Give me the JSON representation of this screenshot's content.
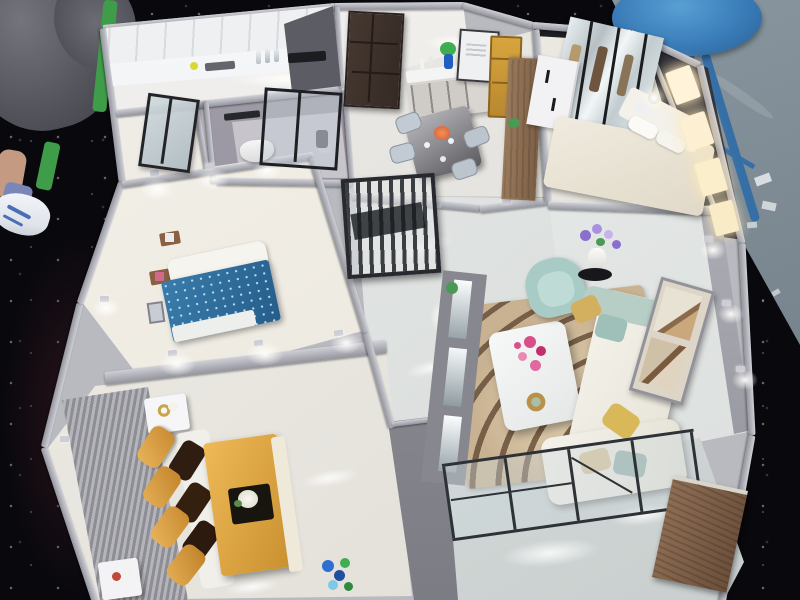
{
  "scene": {
    "type": "photograph",
    "subject": "Miniature cutaway apartment scale model on a dark sparkly exhibition table, viewed from above",
    "environment": {
      "table": {
        "color": "#08080d",
        "sparkle_color": "#aab4ff"
      },
      "showroom_floor": {
        "color": "#8a96a0",
        "paper_scraps": 5
      },
      "blue_stool": {
        "seat_color": "#3a7cb8",
        "leg_color": "#356fa6"
      },
      "bystander": {
        "pants_color": "#5c5c64",
        "skin_color": "#c59a82",
        "sock_color": "#7a86b8",
        "shoe_color": "#eceef2",
        "shoe_stripe_color": "#4a6fb5"
      },
      "green_chair": {
        "color": "#3f9d4a"
      }
    },
    "model": {
      "wall_color": "#b9b9c0",
      "floor_color": "#e9e7e2",
      "accent": {
        "gold_sofa": "#d99f43",
        "dark_pillow": "#2f1d12",
        "gold_table": "#e0a93f",
        "blue_bed": "#2e6f9e",
        "teal_armchair": "#a8cbc6",
        "rug_base": "#c8b292",
        "rug_stripe": "#6e523a",
        "wood_partition": "#8a6a4e",
        "gold_cabinet": "#c8963a",
        "front_door": "#40332c",
        "slat_screen": "#2b2e33",
        "pink_flowers": "#d94f8a",
        "purple_flowers": "#8a6fd0",
        "blue_flowers": "#2f6fd0",
        "wood_cabinet": "#8f6e54",
        "led_cool": "#ffffff",
        "led_warm": "#ffe9b8"
      },
      "rooms": [
        {
          "id": "kitchen",
          "label": "Kitchen",
          "features": [
            "white upper cabinets",
            "counter with bottles",
            "black cooktop",
            "yellow jar"
          ]
        },
        {
          "id": "utility",
          "label": "Utility room",
          "features": [
            "black framed glass door"
          ]
        },
        {
          "id": "bathroom",
          "label": "Bathroom",
          "features": [
            "white toilet",
            "glass shower screen",
            "dark towel rack"
          ]
        },
        {
          "id": "entry",
          "label": "Entry",
          "features": [
            "dark brown front door"
          ]
        },
        {
          "id": "dining",
          "label": "Dining room",
          "features": [
            "glass dining table",
            "four grey chairs",
            "sideboard shelf",
            "leaning art frame",
            "blue vase with plant",
            "gold shelf cabinet",
            "wood partition"
          ]
        },
        {
          "id": "master-bedroom",
          "label": "Master bedroom",
          "features": [
            "mirrored wardrobe",
            "white wardrobe with black handles",
            "double bed with pillows",
            "white bedside lamp"
          ]
        },
        {
          "id": "closet",
          "label": "Lighted closet",
          "features": [
            "warm lit shelves"
          ]
        },
        {
          "id": "hallway",
          "label": "Hallway",
          "features": [
            "glossy marble floor",
            "black slatted screen"
          ]
        },
        {
          "id": "bedroom-2",
          "label": "Second bedroom",
          "features": [
            "blue sparkle bed with white headboard",
            "wood wall shelves with photos",
            "small picture frame"
          ]
        },
        {
          "id": "lounge",
          "label": "Family lounge",
          "features": [
            "gold sofa with dark brown pillows",
            "gold coffee table with black tray and white flowers",
            "two white side tables",
            "grey wood-grain wall"
          ]
        },
        {
          "id": "living-room",
          "label": "Living room",
          "features": [
            "zebra pattern rug",
            "white coffee table with pink flowers",
            "teal armchair",
            "white corner sofa with pillows",
            "purple flower plant on black stand",
            "mirror TV wall with LED strips",
            "framed wall art"
          ]
        },
        {
          "id": "balcony",
          "label": "Balcony",
          "features": [
            "glass railing panels",
            "wood cabinet",
            "glossy marble floor",
            "blue flower pot"
          ]
        }
      ],
      "lighting": {
        "interior": "cool white LED downlights",
        "closet": "warm yellow"
      }
    }
  }
}
